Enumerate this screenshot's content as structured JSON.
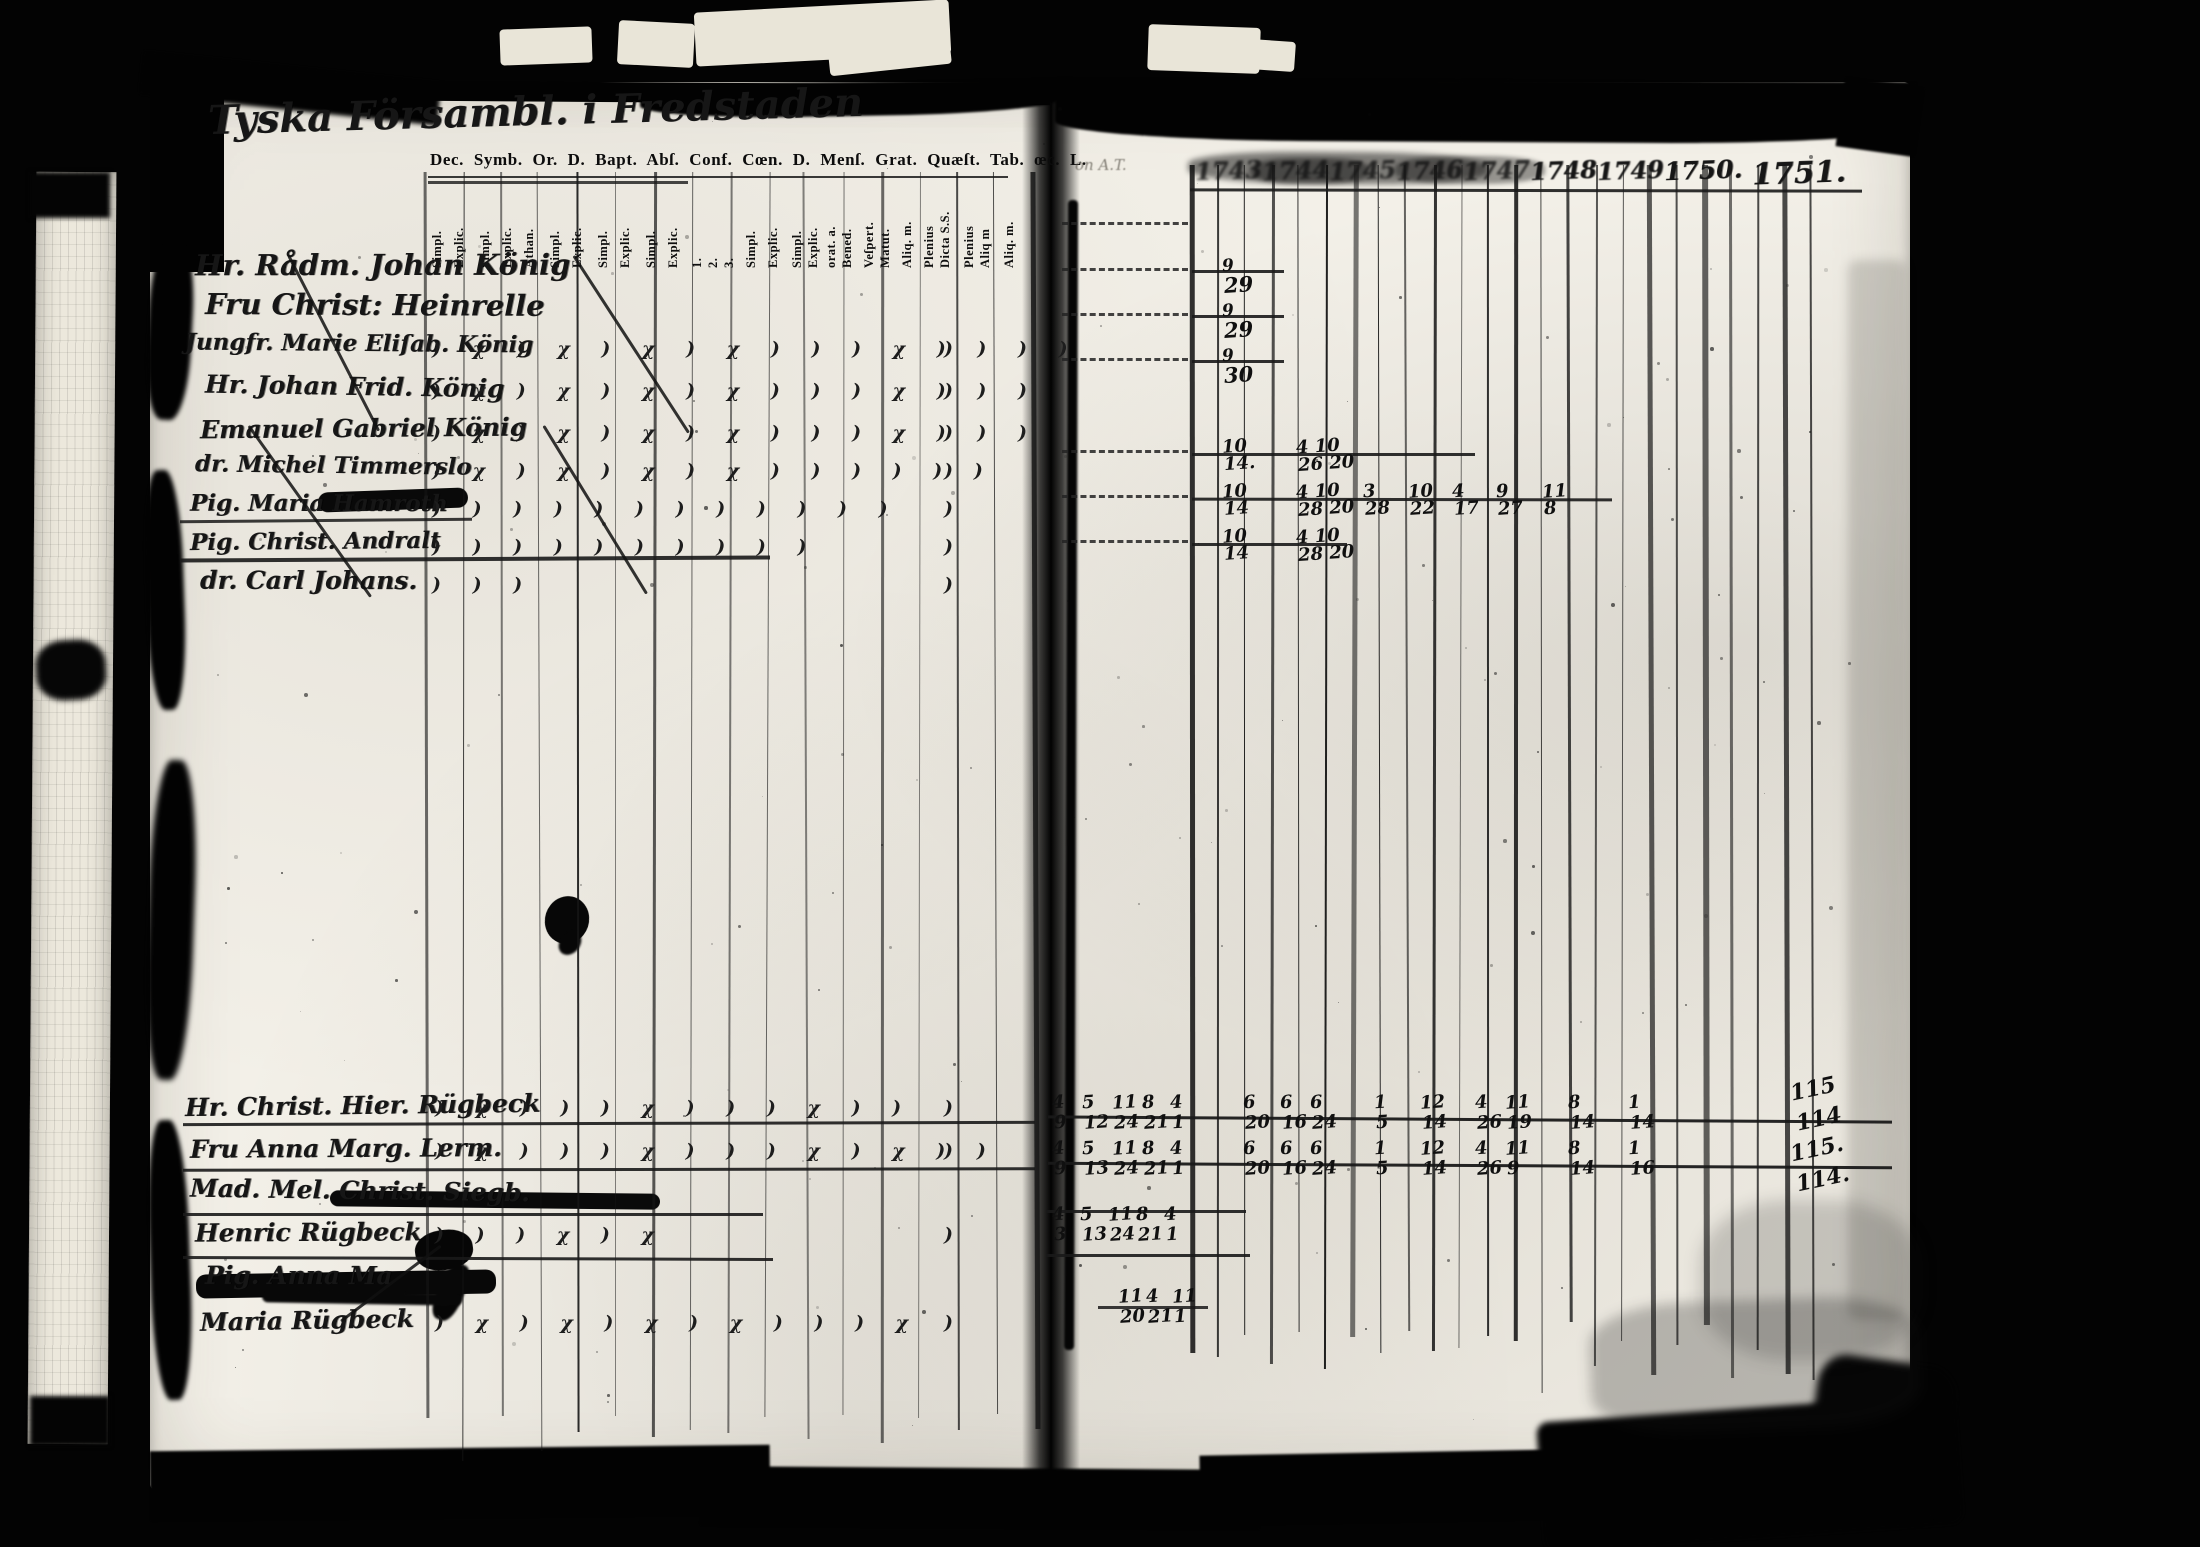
{
  "left_page": {
    "title": "Tyska Försambl. i Fredstaden",
    "header": "Dec. Symb. Or. D. Bapt. Abſ. Conf. Cœn. D. Menſ. Grat. Quæſt. Tab. œc. L.",
    "column_labels": [
      "Simpl.",
      "Explic.",
      "Simpl.",
      "Explic.",
      "Athan.",
      "Simpl.",
      "Explic.",
      "Simpl.",
      "Explic.",
      "Simpl.",
      "Explic.",
      "1.",
      "2.",
      "3.",
      "Simpl.",
      "Explic.",
      "Simpl.",
      "Explic.",
      "orat. a.",
      "Bened.",
      "Veſpert.",
      "Matut.",
      "Aliq. m.",
      "Plenius",
      "Dicta S.S.",
      "Plenius",
      "Aliq m",
      "Aliq. m."
    ],
    "upper_names": [
      {
        "name": "Hr. Rådm. Johan König",
        "marks": "",
        "tail": ""
      },
      {
        "name": "Fru Christ: Heinrelle",
        "marks": "",
        "tail": ""
      },
      {
        "name": "Jungfr. Marie Eliſab. König",
        "marks": ") χ ) χ  ) χ ) χ  ) )  ) χ  ) )  ) )",
        "tail": ")"
      },
      {
        "name": "Hr. Johan Frid. König",
        "marks": ") χ  ) χ  ) χ ) χ  ) )  ) χ )  ) )",
        "tail": ")"
      },
      {
        "name": "Emanuel Gabriel König",
        "marks": ") χ  ) χ  ) χ ) χ  ) )  ) χ )  ) )",
        "tail": ")"
      },
      {
        "name": "dr. Michel Timmerslo",
        "marks": ") χ  ) χ  ) χ ) χ  ) )  ) )  ) )",
        "tail": ")"
      },
      {
        "name": "Pig. Maria Hamroth",
        "marks": ") )  ) )  ) )  ) )  ) )  ) )",
        "tail": ")"
      },
      {
        "name": "Pig. Christ. Andralt",
        "marks": ") )  ) )  ) )  ) )  ) )",
        "tail": ")"
      },
      {
        "name": "dr. Carl Johans.",
        "marks": ")  )   )",
        "tail": ")"
      }
    ],
    "lower_names": [
      {
        "name": "Hr. Christ. Hier. Rügbeck",
        "marks": ") χ  ) )  ) χ  ) )  ) χ  ) )",
        "tail": ")"
      },
      {
        "name": "Fru Anna Marg. Lerm.",
        "marks": ") χ ) )  ) χ ) )  ) χ  ) χ  ) )",
        "tail": ")"
      },
      {
        "name": "Mad. Mel. Christ. Siegb.",
        "marks": "",
        "tail": ""
      },
      {
        "name": "Henric Rügbeck",
        "marks": ") )  ) χ  ) χ",
        "tail": ")"
      },
      {
        "name": "Pig. Anna Ma",
        "marks": "",
        "tail": ""
      },
      {
        "name": "Maria Rügbeck",
        "marks": ") χ ) χ  ) χ ) χ  ) )  ) χ",
        "tail": ")"
      }
    ]
  },
  "right_page": {
    "note": "on A.T.",
    "years": [
      "1743",
      "1744",
      "1745",
      "1746",
      "1747",
      "1748",
      "1749",
      "1750.",
      "1751."
    ],
    "top_tallies": [
      [
        "9",
        "29"
      ],
      [
        "9",
        "29"
      ],
      [
        "9",
        "30"
      ]
    ],
    "mid_rows": [
      {
        "pairs": [
          [
            "10",
            "14."
          ],
          [
            "4 10",
            "26 20"
          ]
        ]
      },
      {
        "pairs": [
          [
            "10",
            "14"
          ],
          [
            "4 10",
            "28 20"
          ],
          [
            "3",
            "28"
          ],
          [
            "10",
            "22"
          ],
          [
            "4",
            "17"
          ],
          [
            "9",
            "27"
          ],
          [
            "11",
            "8"
          ]
        ]
      },
      {
        "pairs": [
          [
            "10",
            "14"
          ],
          [
            "4 10",
            "28 20"
          ]
        ]
      }
    ],
    "bottom_rows": [
      {
        "pairs": [
          [
            "4",
            "9"
          ],
          [
            "5",
            "12"
          ],
          [
            "11",
            "24"
          ],
          [
            "8",
            "21"
          ],
          [
            "4",
            "1"
          ],
          [
            "6",
            "20"
          ],
          [
            "6",
            "16"
          ],
          [
            "6",
            "24"
          ],
          [
            "1",
            "5"
          ],
          [
            "12",
            "14"
          ],
          [
            "4",
            "26"
          ],
          [
            "11",
            "19"
          ],
          [
            "8",
            "14"
          ],
          [
            "1",
            "14"
          ]
        ]
      },
      {
        "pairs": [
          [
            "4",
            "9"
          ],
          [
            "5",
            "13"
          ],
          [
            "11",
            "24"
          ],
          [
            "8",
            "21"
          ],
          [
            "4",
            "1"
          ],
          [
            "6",
            "20"
          ],
          [
            "6",
            "16"
          ],
          [
            "6",
            "24"
          ],
          [
            "1",
            "5"
          ],
          [
            "12",
            "14"
          ],
          [
            "4",
            "26"
          ],
          [
            "11",
            "9"
          ],
          [
            "8",
            "14"
          ],
          [
            "1",
            "16"
          ]
        ]
      },
      {
        "pairs": [
          [
            "4",
            "3"
          ],
          [
            "5",
            "13"
          ],
          [
            "11",
            "24"
          ],
          [
            "8",
            "21"
          ],
          [
            "4",
            "1"
          ]
        ]
      },
      {
        "pairs": [
          [
            "11",
            "20"
          ],
          [
            "4",
            "21"
          ],
          [
            "11",
            "1"
          ]
        ]
      }
    ],
    "totals": [
      "115",
      "114",
      "115.",
      "114."
    ]
  }
}
